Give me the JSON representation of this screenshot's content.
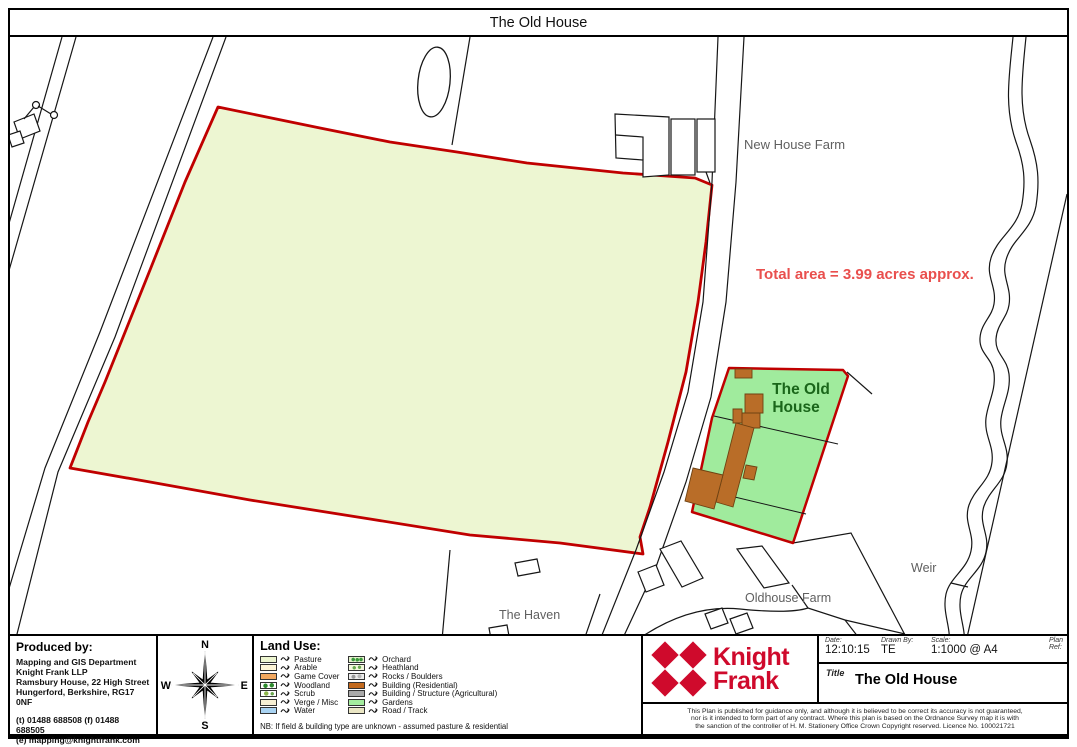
{
  "title_bar": {
    "title": "The Old House"
  },
  "map": {
    "labels": {
      "new_house_farm": "New House Farm",
      "total_area": "Total area = 3.99 acres approx.",
      "old_house_line1": "The Old",
      "old_house_line2": "House",
      "weir": "Weir",
      "oldhouse_farm": "Oldhouse Farm",
      "the_haven": "The Haven"
    },
    "colors": {
      "boundary_red": "#c00000",
      "pasture_fill": "#edf6d2",
      "gardens_fill": "#a0eb9d",
      "building_fill": "#b96d28",
      "label_gray": "#5f5f5f",
      "area_text_red": "#e94f4d",
      "old_house_text_green": "#1a661a"
    }
  },
  "footer": {
    "produced_by": {
      "heading": "Produced by:",
      "lines": [
        "Mapping and GIS Department",
        "Knight Frank LLP",
        "Ramsbury House, 22 High Street",
        "Hungerford, Berkshire, RG17 0NF",
        "(t) 01488 688508 (f) 01488 688505",
        "(e) mapping@knightfrank.com"
      ]
    },
    "compass": {
      "n": "N",
      "e": "E",
      "s": "S",
      "w": "W"
    },
    "legend": {
      "heading": "Land Use:",
      "col1": [
        {
          "label": "Pasture",
          "color": "#ecf5cf"
        },
        {
          "label": "Arable",
          "color": "#fdf5d7"
        },
        {
          "label": "Game Cover",
          "color": "#f2a860"
        },
        {
          "label": "Woodland",
          "color": "#2e8b2e"
        },
        {
          "label": "Scrub",
          "color": "#8db54b"
        },
        {
          "label": "Verge / Misc",
          "color": "#f7efd3"
        },
        {
          "label": "Water",
          "color": "#a9d3f2"
        }
      ],
      "col2": [
        {
          "label": "Orchard",
          "color": "#e4f2cc"
        },
        {
          "label": "Heathland",
          "color": "#f2f7dc"
        },
        {
          "label": "Rocks / Boulders",
          "color": "#ececec"
        },
        {
          "label": "Building (Residential)",
          "color": "#c2691e"
        },
        {
          "label": "Building / Structure (Agricultural)",
          "color": "#a9a9a9"
        },
        {
          "label": "Gardens",
          "color": "#a5ed9f"
        },
        {
          "label": "Road / Track",
          "color": "#eae6c4"
        }
      ],
      "note": "NB: If field & building type are unknown - assumed pasture & residential"
    },
    "brand": {
      "name_line1": "Knight",
      "name_line2": "Frank",
      "color": "#cf0a2c"
    },
    "info": {
      "date_label": "Date:",
      "date": "12:10:15",
      "drawn_by_label": "Drawn By:",
      "drawn_by": "TE",
      "scale_label": "Scale:",
      "scale": "1:1000 @ A4",
      "plan_ref_label": "Plan Ref:",
      "plan_ref": "",
      "title_label": "Title",
      "title": "The Old House"
    },
    "disclaimer": [
      "This Plan is published for guidance only, and although it is believed to be correct its accuracy is not guaranteed,",
      "nor is it intended to form part of any contract.     Where this plan is based on the Ordnance Survey map it is with",
      "the sanction of the controller of H. M. Stationery Office Crown Copyright reserved. Licence No. 100021721"
    ]
  }
}
